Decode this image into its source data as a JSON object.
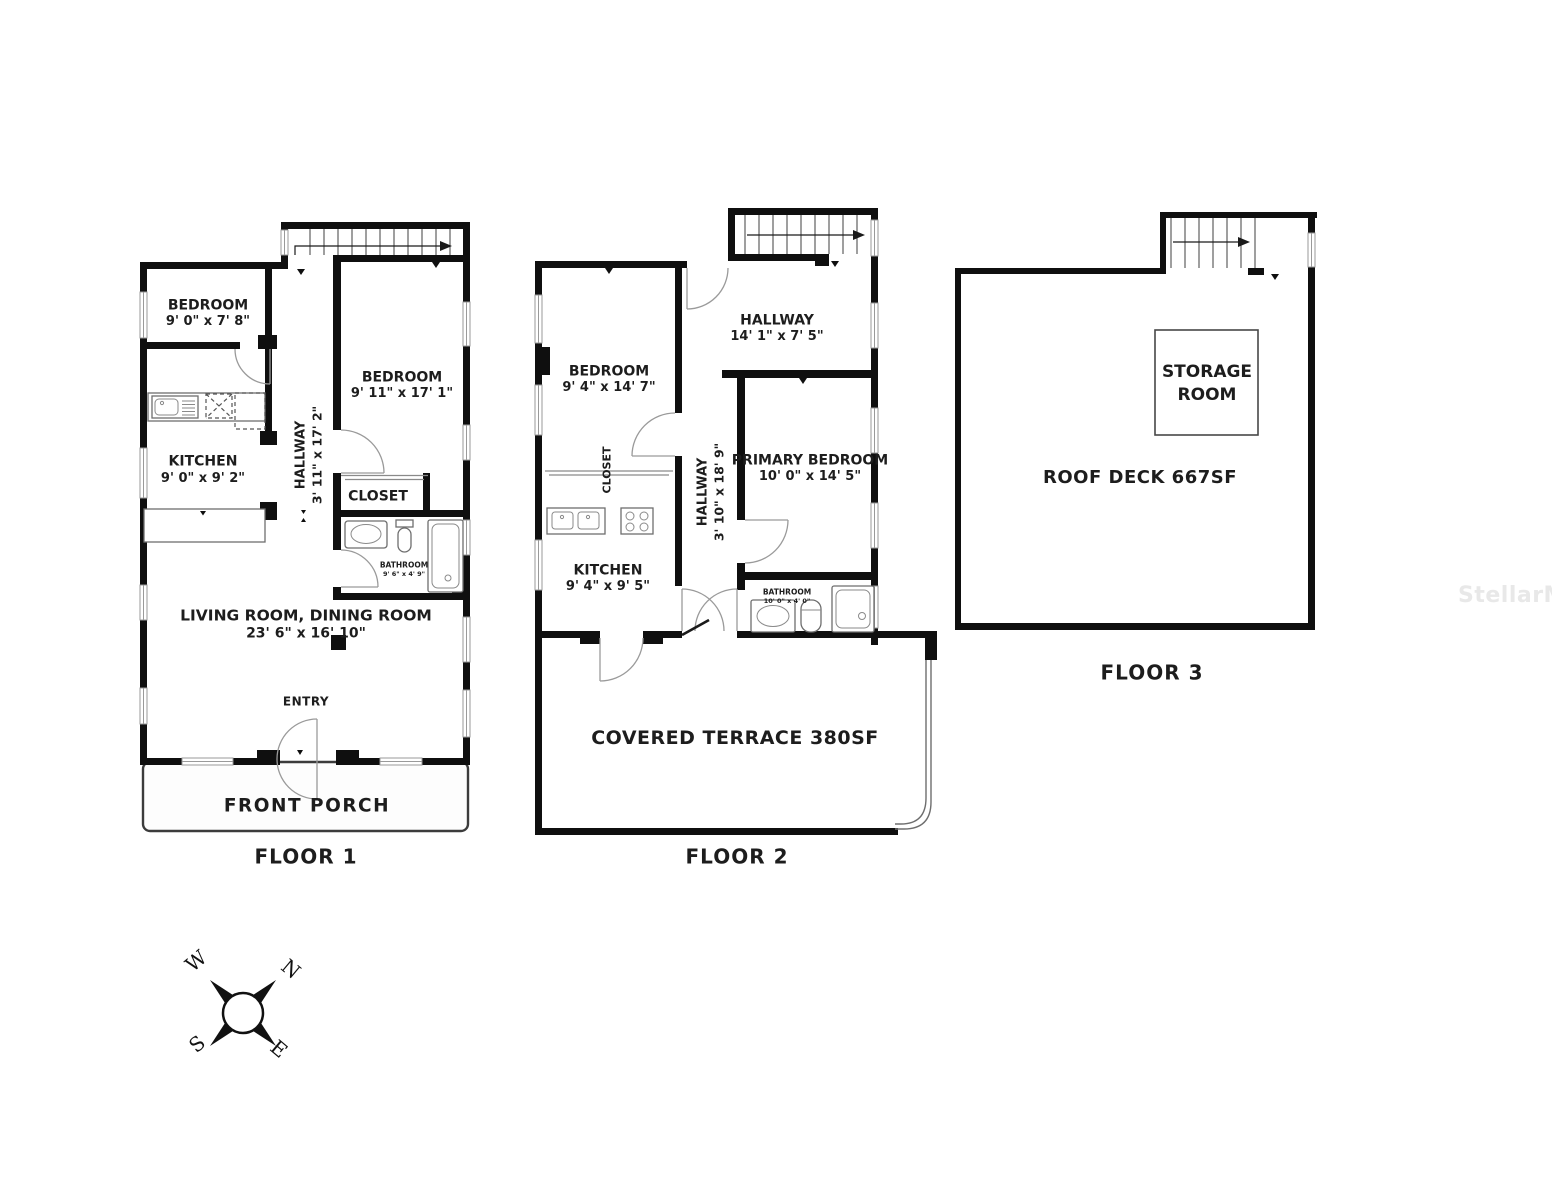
{
  "floors": [
    {
      "label": "FLOOR 1",
      "rooms": {
        "bedroom_1": {
          "name": "BEDROOM",
          "dims": "9' 0\" x 7' 8\""
        },
        "bedroom_2": {
          "name": "BEDROOM",
          "dims": "9' 11\" x 17' 1\""
        },
        "kitchen": {
          "name": "KITCHEN",
          "dims": "9' 0\" x 9' 2\""
        },
        "hallway": {
          "name": "HALLWAY",
          "dims": "3' 11\" x 17' 2\""
        },
        "closet": {
          "name": "CLOSET"
        },
        "bathroom": {
          "name": "BATHROOM",
          "dims": "9' 6\" x 4' 9\""
        },
        "living_dining": {
          "name": "LIVING ROOM, DINING ROOM",
          "dims": "23' 6\" x 16' 10\""
        },
        "entry": {
          "name": "ENTRY"
        },
        "front_porch": {
          "name": "FRONT PORCH"
        }
      }
    },
    {
      "label": "FLOOR 2",
      "rooms": {
        "bedroom": {
          "name": "BEDROOM",
          "dims": "9' 4\" x 14' 7\""
        },
        "hallway_upper": {
          "name": "HALLWAY",
          "dims": "14' 1\" x 7' 5\""
        },
        "primary_bedroom": {
          "name": "PRIMARY BEDROOM",
          "dims": "10' 0\" x 14' 5\""
        },
        "hallway": {
          "name": "HALLWAY",
          "dims": "3' 10\" x 18' 9\""
        },
        "closet": {
          "name": "CLOSET"
        },
        "kitchen": {
          "name": "KITCHEN",
          "dims": "9' 4\" x 9' 5\""
        },
        "bathroom": {
          "name": "BATHROOM",
          "dims": "10' 0\" x 4' 0\""
        },
        "covered_terrace": {
          "name": "COVERED TERRACE 380SF"
        }
      }
    },
    {
      "label": "FLOOR 3",
      "rooms": {
        "storage_room": {
          "name": "STORAGE ROOM"
        },
        "roof_deck": {
          "name": "ROOF DECK 667SF"
        }
      }
    }
  ],
  "compass": {
    "north": "N",
    "south": "S",
    "east": "E",
    "west": "W"
  },
  "watermark": "StellarMLS",
  "colors": {
    "wall": "#0f0f0f",
    "door": "#9a9a9a",
    "text": "#1d1d1d",
    "watermark": "#e8e8e8"
  }
}
